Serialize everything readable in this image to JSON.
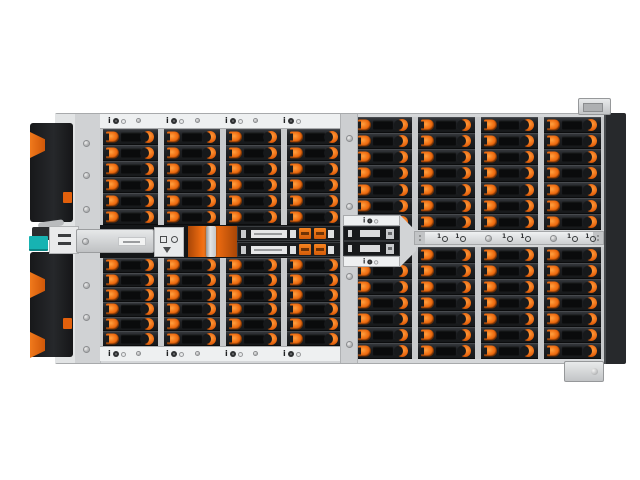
{
  "meta": {
    "subject": "Top view of a high-density rackmount JBOD storage enclosure with hot-swap drive bays and orange release latches",
    "background": "#ffffff"
  },
  "colors": {
    "accent_orange": "#EF6C10",
    "chassis_gray": "#D5D7D9",
    "rail_white": "#EEF0F1",
    "drive_dark": "#1B1D1F",
    "panel_black": "#1E2023",
    "connector_teal": "#17B3B2",
    "edge_dark": "#27292C"
  },
  "enclosure": {
    "layout": {
      "left_bank": {
        "columns": 4,
        "rows_top": 6,
        "rows_bottom": 6
      },
      "right_bank": {
        "columns": 4,
        "rows_top": 7,
        "rows_bottom": 7
      },
      "visible_drive_bays_total": 104,
      "io_marks_per_rail": 4,
      "mid_strip_icon_groups": 3,
      "center_module_trays": 2,
      "left_band_trays": 2
    },
    "glyphs": {
      "io_letter": "i",
      "strip_numeral": "1"
    }
  }
}
